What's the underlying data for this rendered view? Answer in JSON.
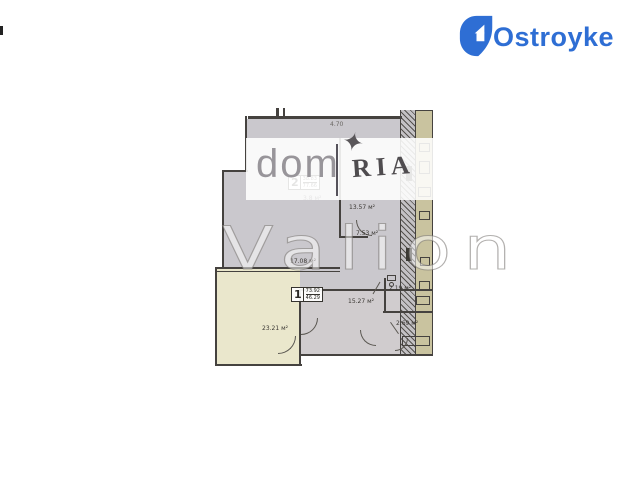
{
  "brand": {
    "logo_text": "Ostroyke",
    "color": "#2e6ed4"
  },
  "watermarks": {
    "dom": "dom",
    "ria": "RIA",
    "star": "✦",
    "valion": "Valion"
  },
  "plan": {
    "apartments": [
      {
        "number": "2",
        "area_top": "38.83",
        "area_bottom": "77.66"
      },
      {
        "number": "1",
        "area_top": "73.92",
        "area_bottom": "46.29"
      }
    ],
    "dimension": "4.70",
    "room_labels": [
      "3.8 м²",
      "13.57 м²",
      "7.53 м²",
      "17.08 м²",
      "15.27 м²",
      "2.19 м²",
      "2.69 м²",
      "23.21 м²"
    ],
    "colors": {
      "floor": "#cac8cd",
      "corridor": "#d0ccce",
      "service_strip": "#c9c39f",
      "apartment1_floor": "#eae7cc",
      "wall": "#45423f"
    }
  }
}
